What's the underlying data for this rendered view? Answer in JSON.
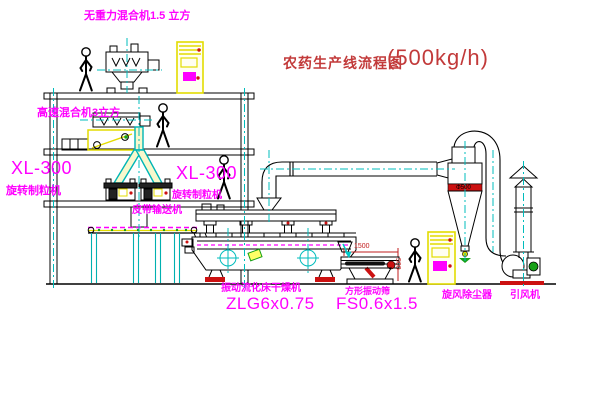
{
  "title": {
    "name": "农药生产线流程图",
    "capacity": "(500kg/h)"
  },
  "equipment_labels": {
    "top_mixer": "无重力混合机1.5 立方",
    "mid_mixer": "高速混合机3立方",
    "granulator_left": {
      "model": "XL-300",
      "name": "旋转制粒机"
    },
    "granulator_right": {
      "model": "XL-300",
      "name": "旋转制粒机"
    },
    "belt_conveyor": "皮带输送机",
    "dryer": {
      "name": "振动流化床干燥机",
      "model": "ZLG6x0.75"
    },
    "screen": {
      "name": "方形振动筛",
      "model": "FS0.6x1.5"
    },
    "cyclone": "旋风除尘器",
    "fan": "引风机"
  },
  "dimensions": {
    "screen_length": "1500",
    "screen_height": "500",
    "cyclone_marking": "Φ500"
  },
  "colors": {
    "label_magenta": "#ff00ff",
    "title_red": "#c23a3a",
    "equipment_yellow": "#e3dc00",
    "centerline_cyan": "#00bcbc",
    "accent_red": "#cc1111",
    "accent_green": "#17a017"
  }
}
